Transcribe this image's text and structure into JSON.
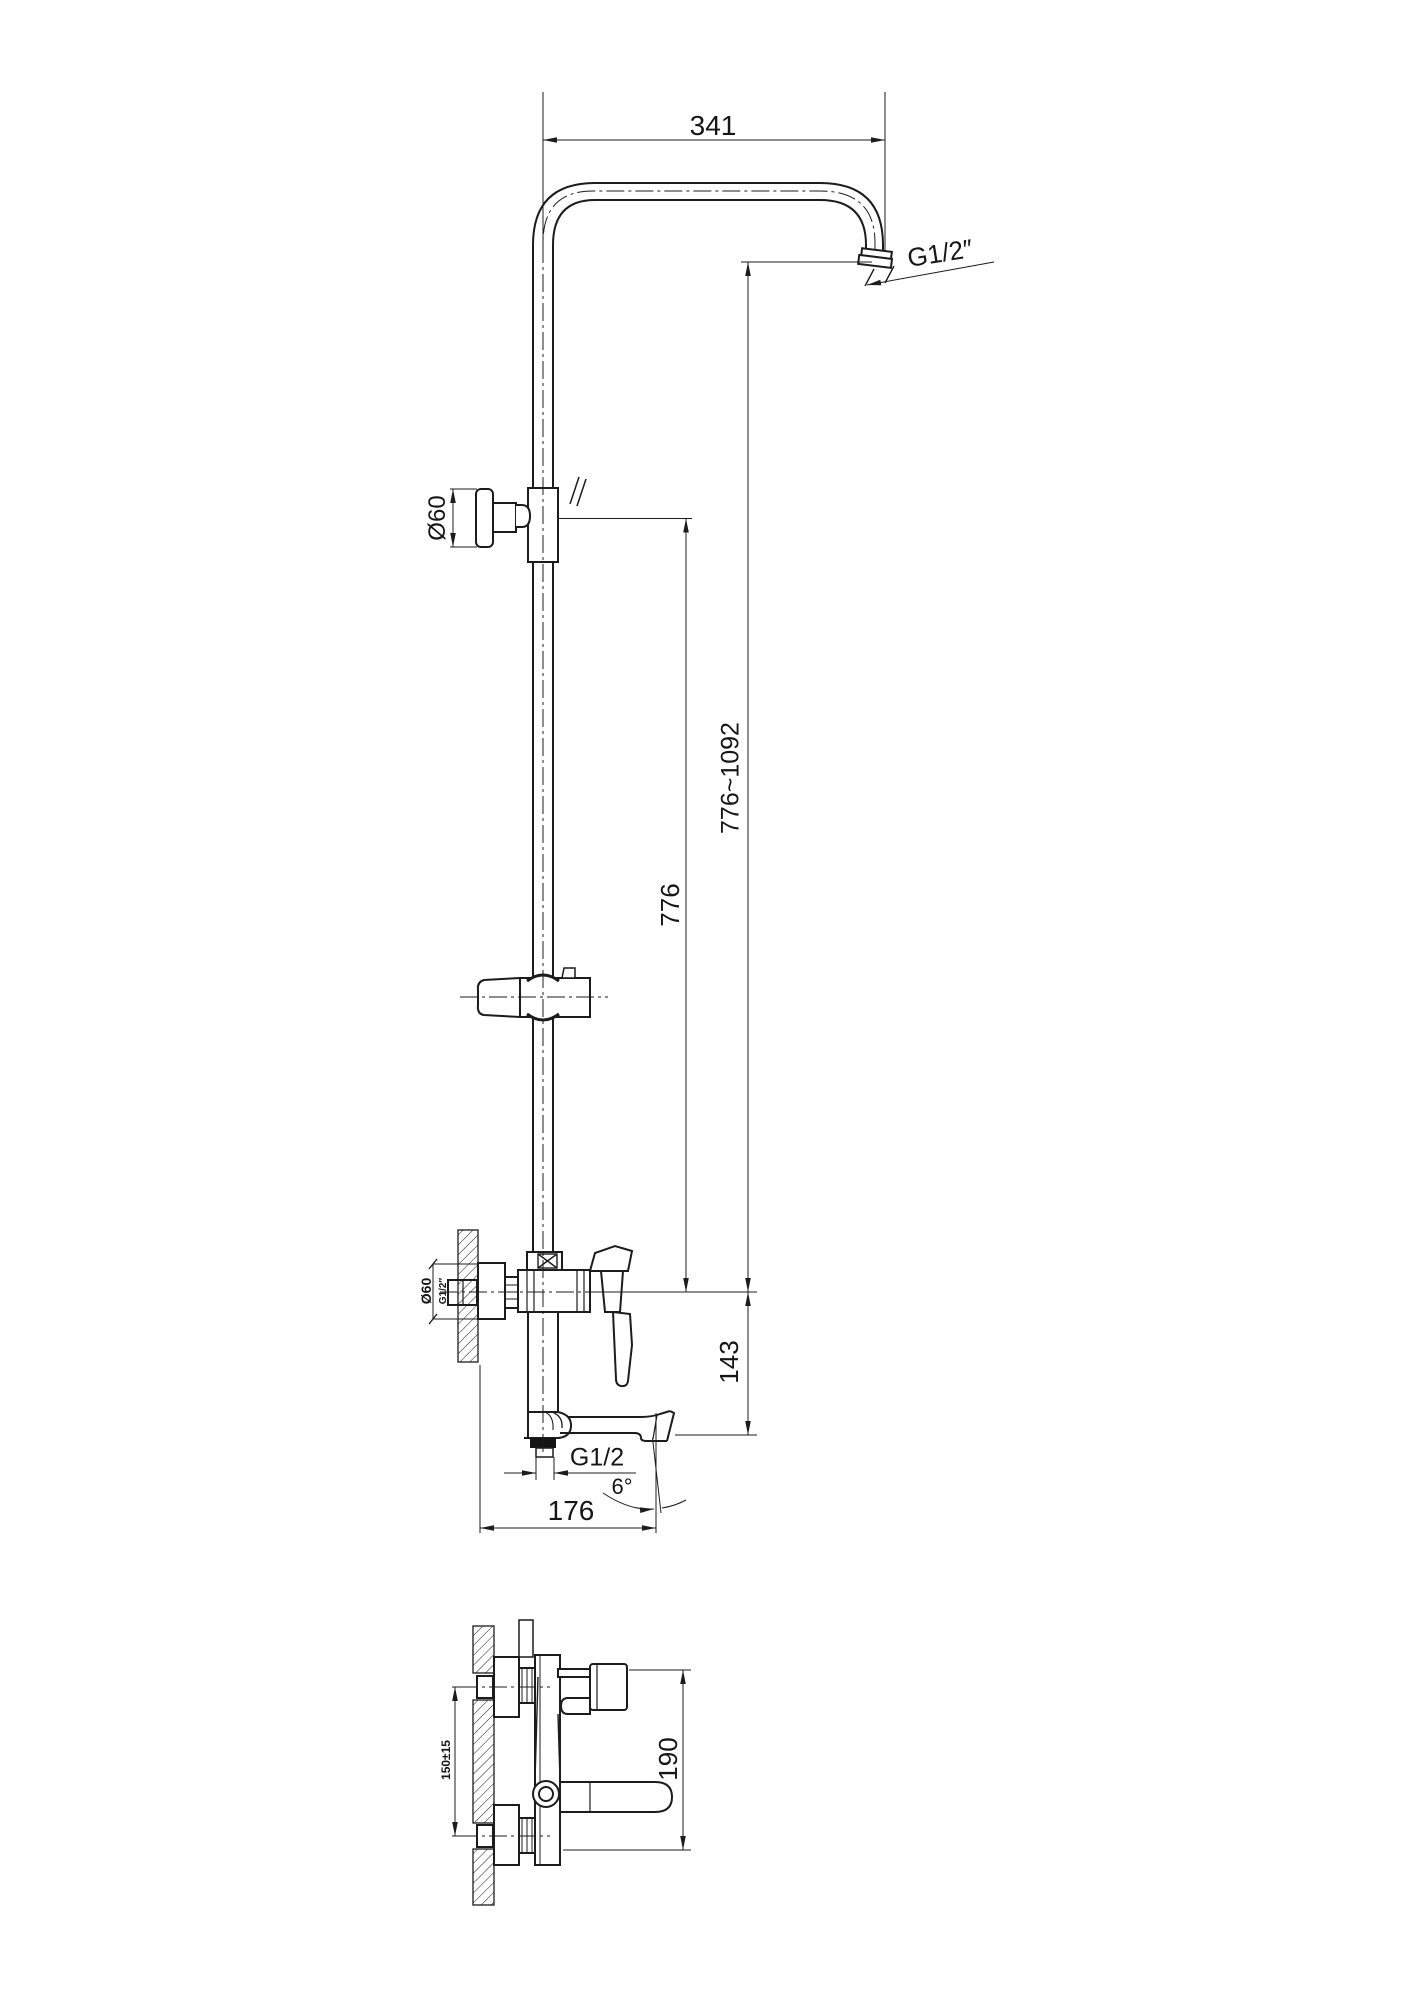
{
  "drawing": {
    "type": "technical-line-drawing",
    "subject": "shower-column-and-bath-mixer-installation-diagram",
    "background": "#ffffff",
    "line_color": "#1c1c1c"
  },
  "labels": {
    "dim_arm_width": "341",
    "arm_outlet_thread": "G1/2″",
    "slider_knob_diameter": "Ø60",
    "dim_height_range": "776~1092",
    "dim_height_fixed": "776",
    "valve_escutcheon_diameter": "Ø60",
    "valve_inlet_thread": "G1/2″",
    "dim_spout_drop": "143",
    "spout_outlet_thread": "G1/2",
    "spout_angle": "6°",
    "dim_wall_to_spout": "176",
    "inlet_spacing": "150±15",
    "dim_plan_depth": "190"
  }
}
